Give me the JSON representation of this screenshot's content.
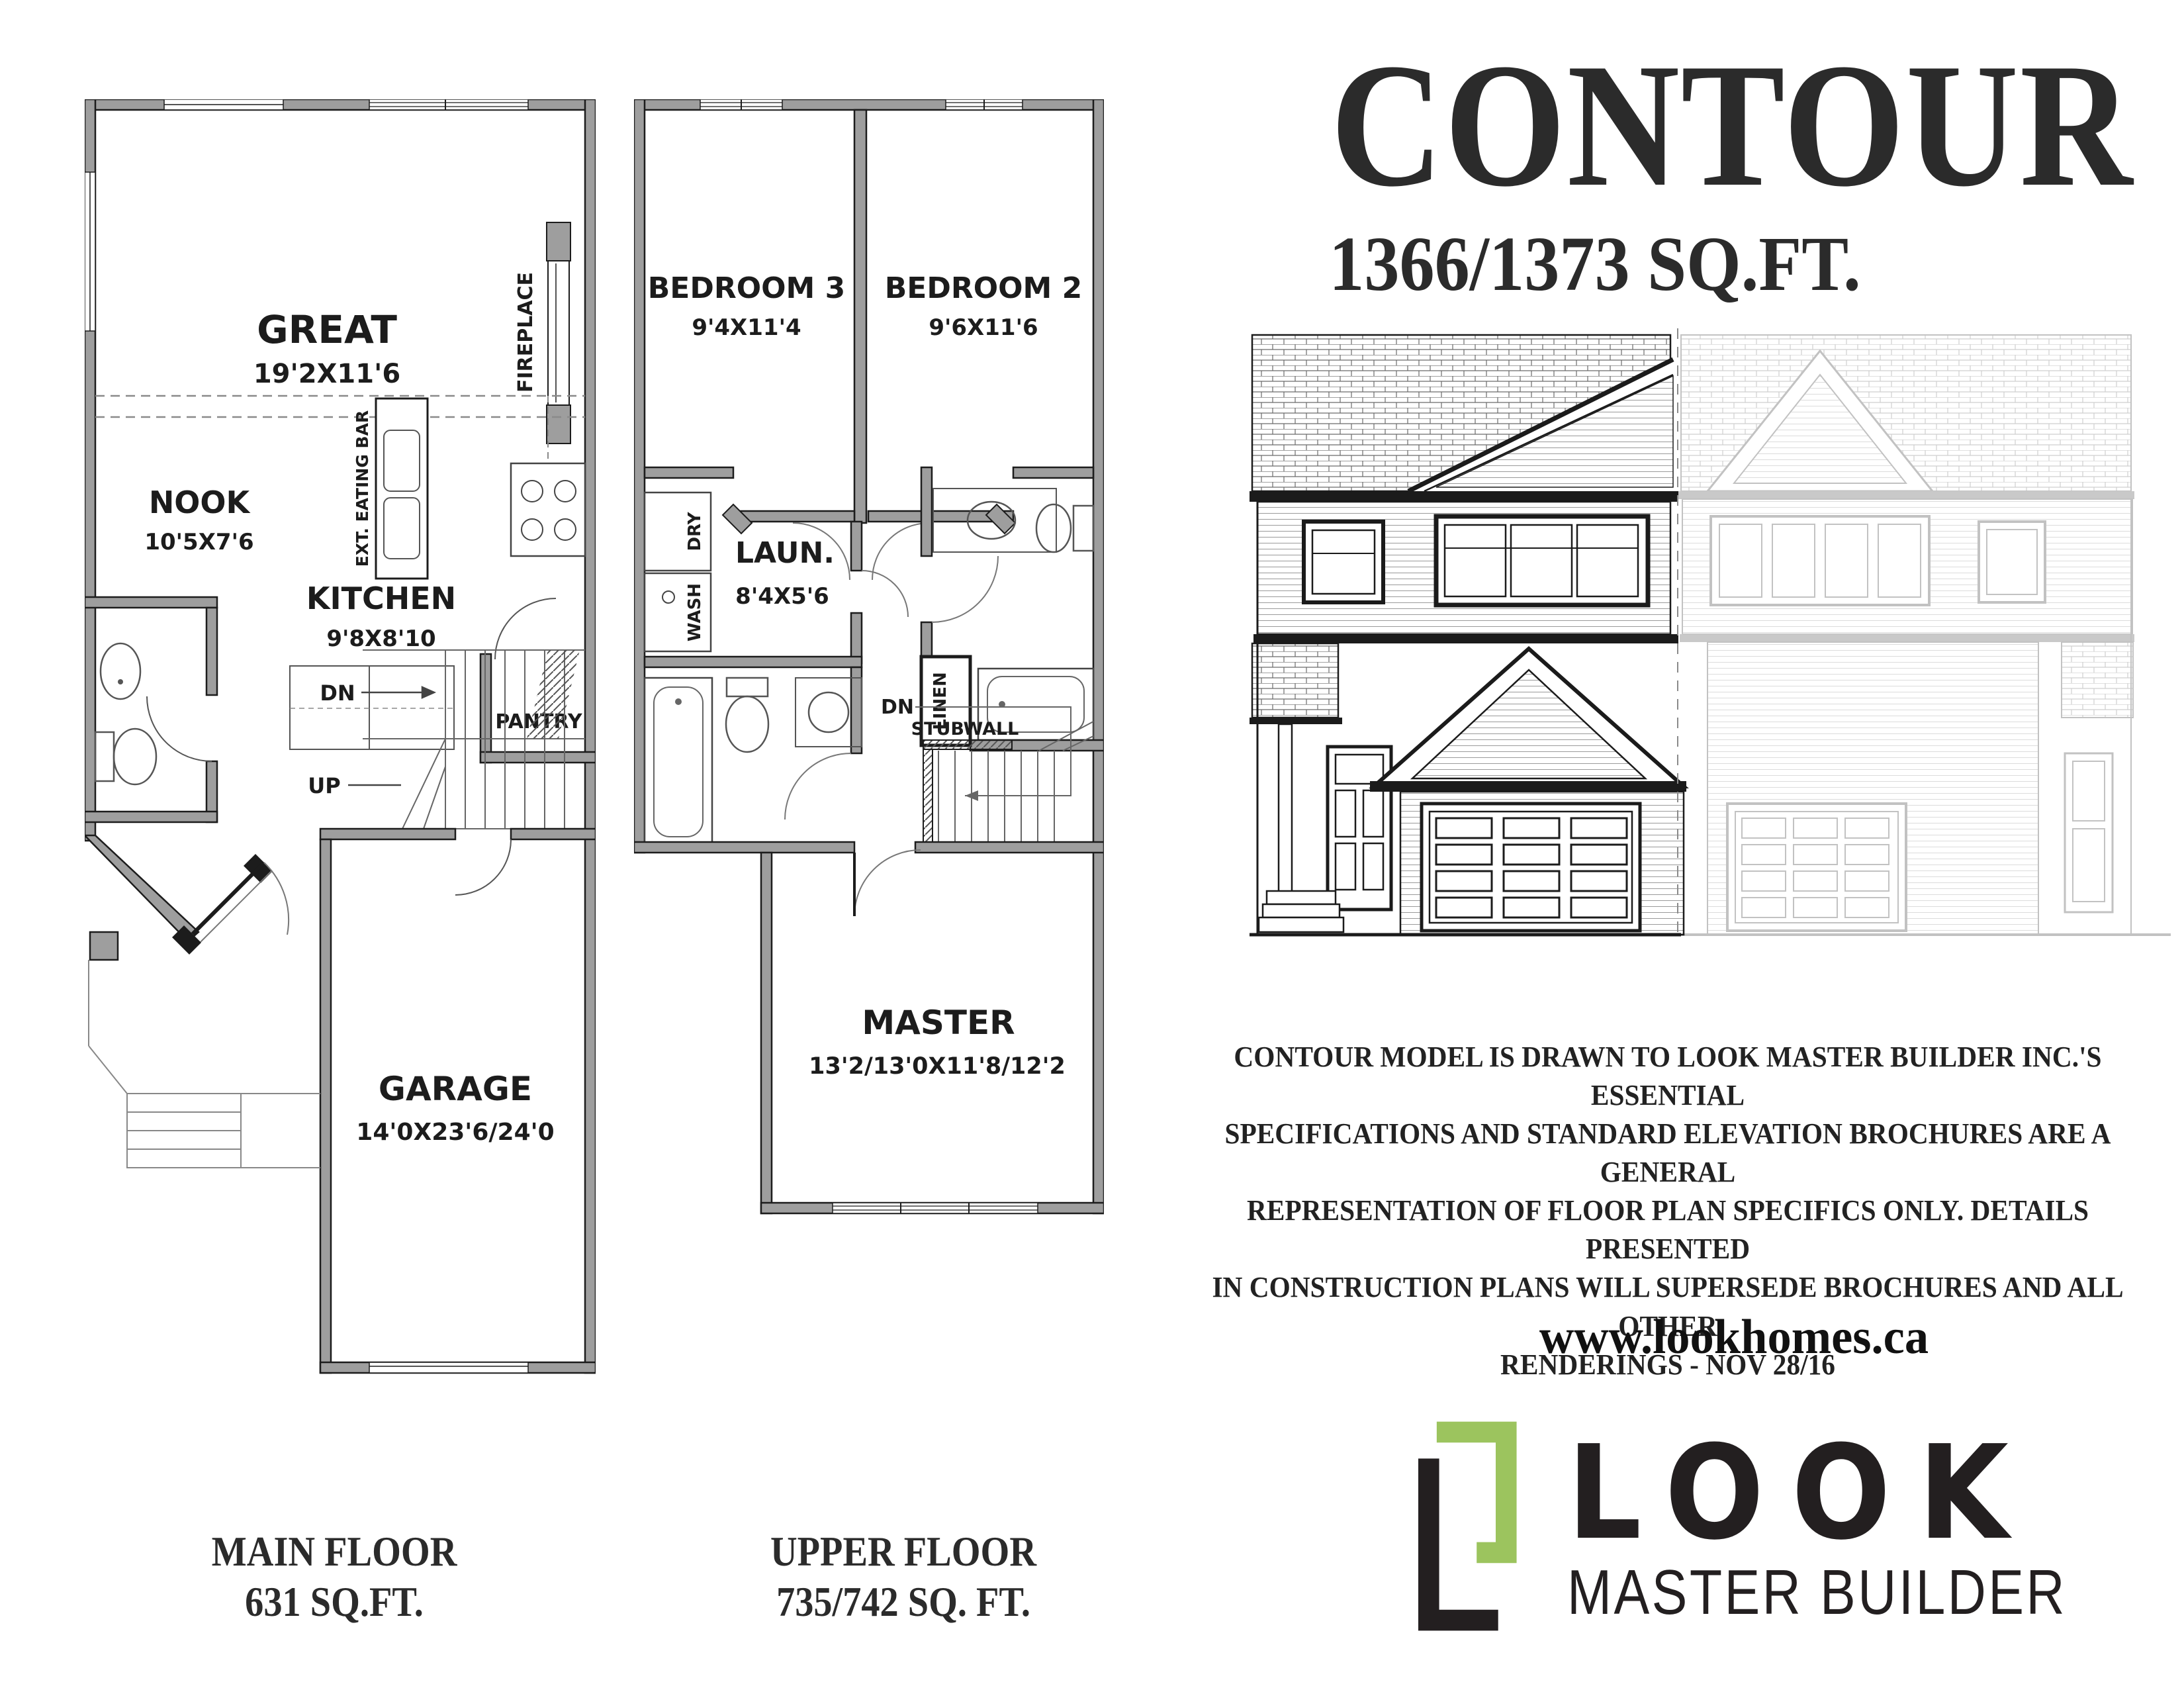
{
  "header": {
    "title": "CONTOUR",
    "sqft": "1366/1373 SQ.FT."
  },
  "disclaimer": {
    "line1": "CONTOUR MODEL IS DRAWN TO LOOK MASTER BUILDER INC.'S  ESSENTIAL",
    "line2": "SPECIFICATIONS AND STANDARD ELEVATION BROCHURES ARE A  GENERAL",
    "line3": "REPRESENTATION OF FLOOR PLAN SPECIFICS ONLY. DETAILS PRESENTED",
    "line4": "IN CONSTRUCTION PLANS WILL SUPERSEDE BROCHURES AND ALL OTHER",
    "line5": "RENDERINGS - NOV 28/16"
  },
  "footer": {
    "website": "www.lookhomes.ca",
    "logo_word": "LOOK",
    "logo_subtitle": "MASTER BUILDER",
    "logo_green": "#9cc45e",
    "logo_black": "#231f20"
  },
  "main_floor": {
    "caption_line1": "MAIN FLOOR",
    "caption_line2": "631 SQ.FT.",
    "great_name": "GREAT",
    "great_dims": "19'2X11'6",
    "fireplace": "FIREPLACE",
    "nook_name": "NOOK",
    "nook_dims": "10'5X7'6",
    "eating_bar": "EXT. EATING BAR",
    "kitchen_name": "KITCHEN",
    "kitchen_dims": "9'8X8'10",
    "pantry": "PANTRY",
    "dn": "DN",
    "up": "UP",
    "garage_name": "GARAGE",
    "garage_dims": "14'0X23'6/24'0"
  },
  "upper_floor": {
    "caption_line1": "UPPER FLOOR",
    "caption_line2": "735/742 SQ. FT.",
    "bedroom3_name": "BEDROOM 3",
    "bedroom3_dims": "9'4X11'4",
    "bedroom2_name": "BEDROOM 2",
    "bedroom2_dims": "9'6X11'6",
    "laundry_name": "LAUN.",
    "laundry_dims": "8'4X5'6",
    "wash": "WASH",
    "dry": "DRY",
    "linen": "LINEN",
    "dn": "DN",
    "stubwall": "STUBWALL",
    "master_name": "MASTER",
    "master_dims": "13'2/13'0X11'8/12'2"
  }
}
